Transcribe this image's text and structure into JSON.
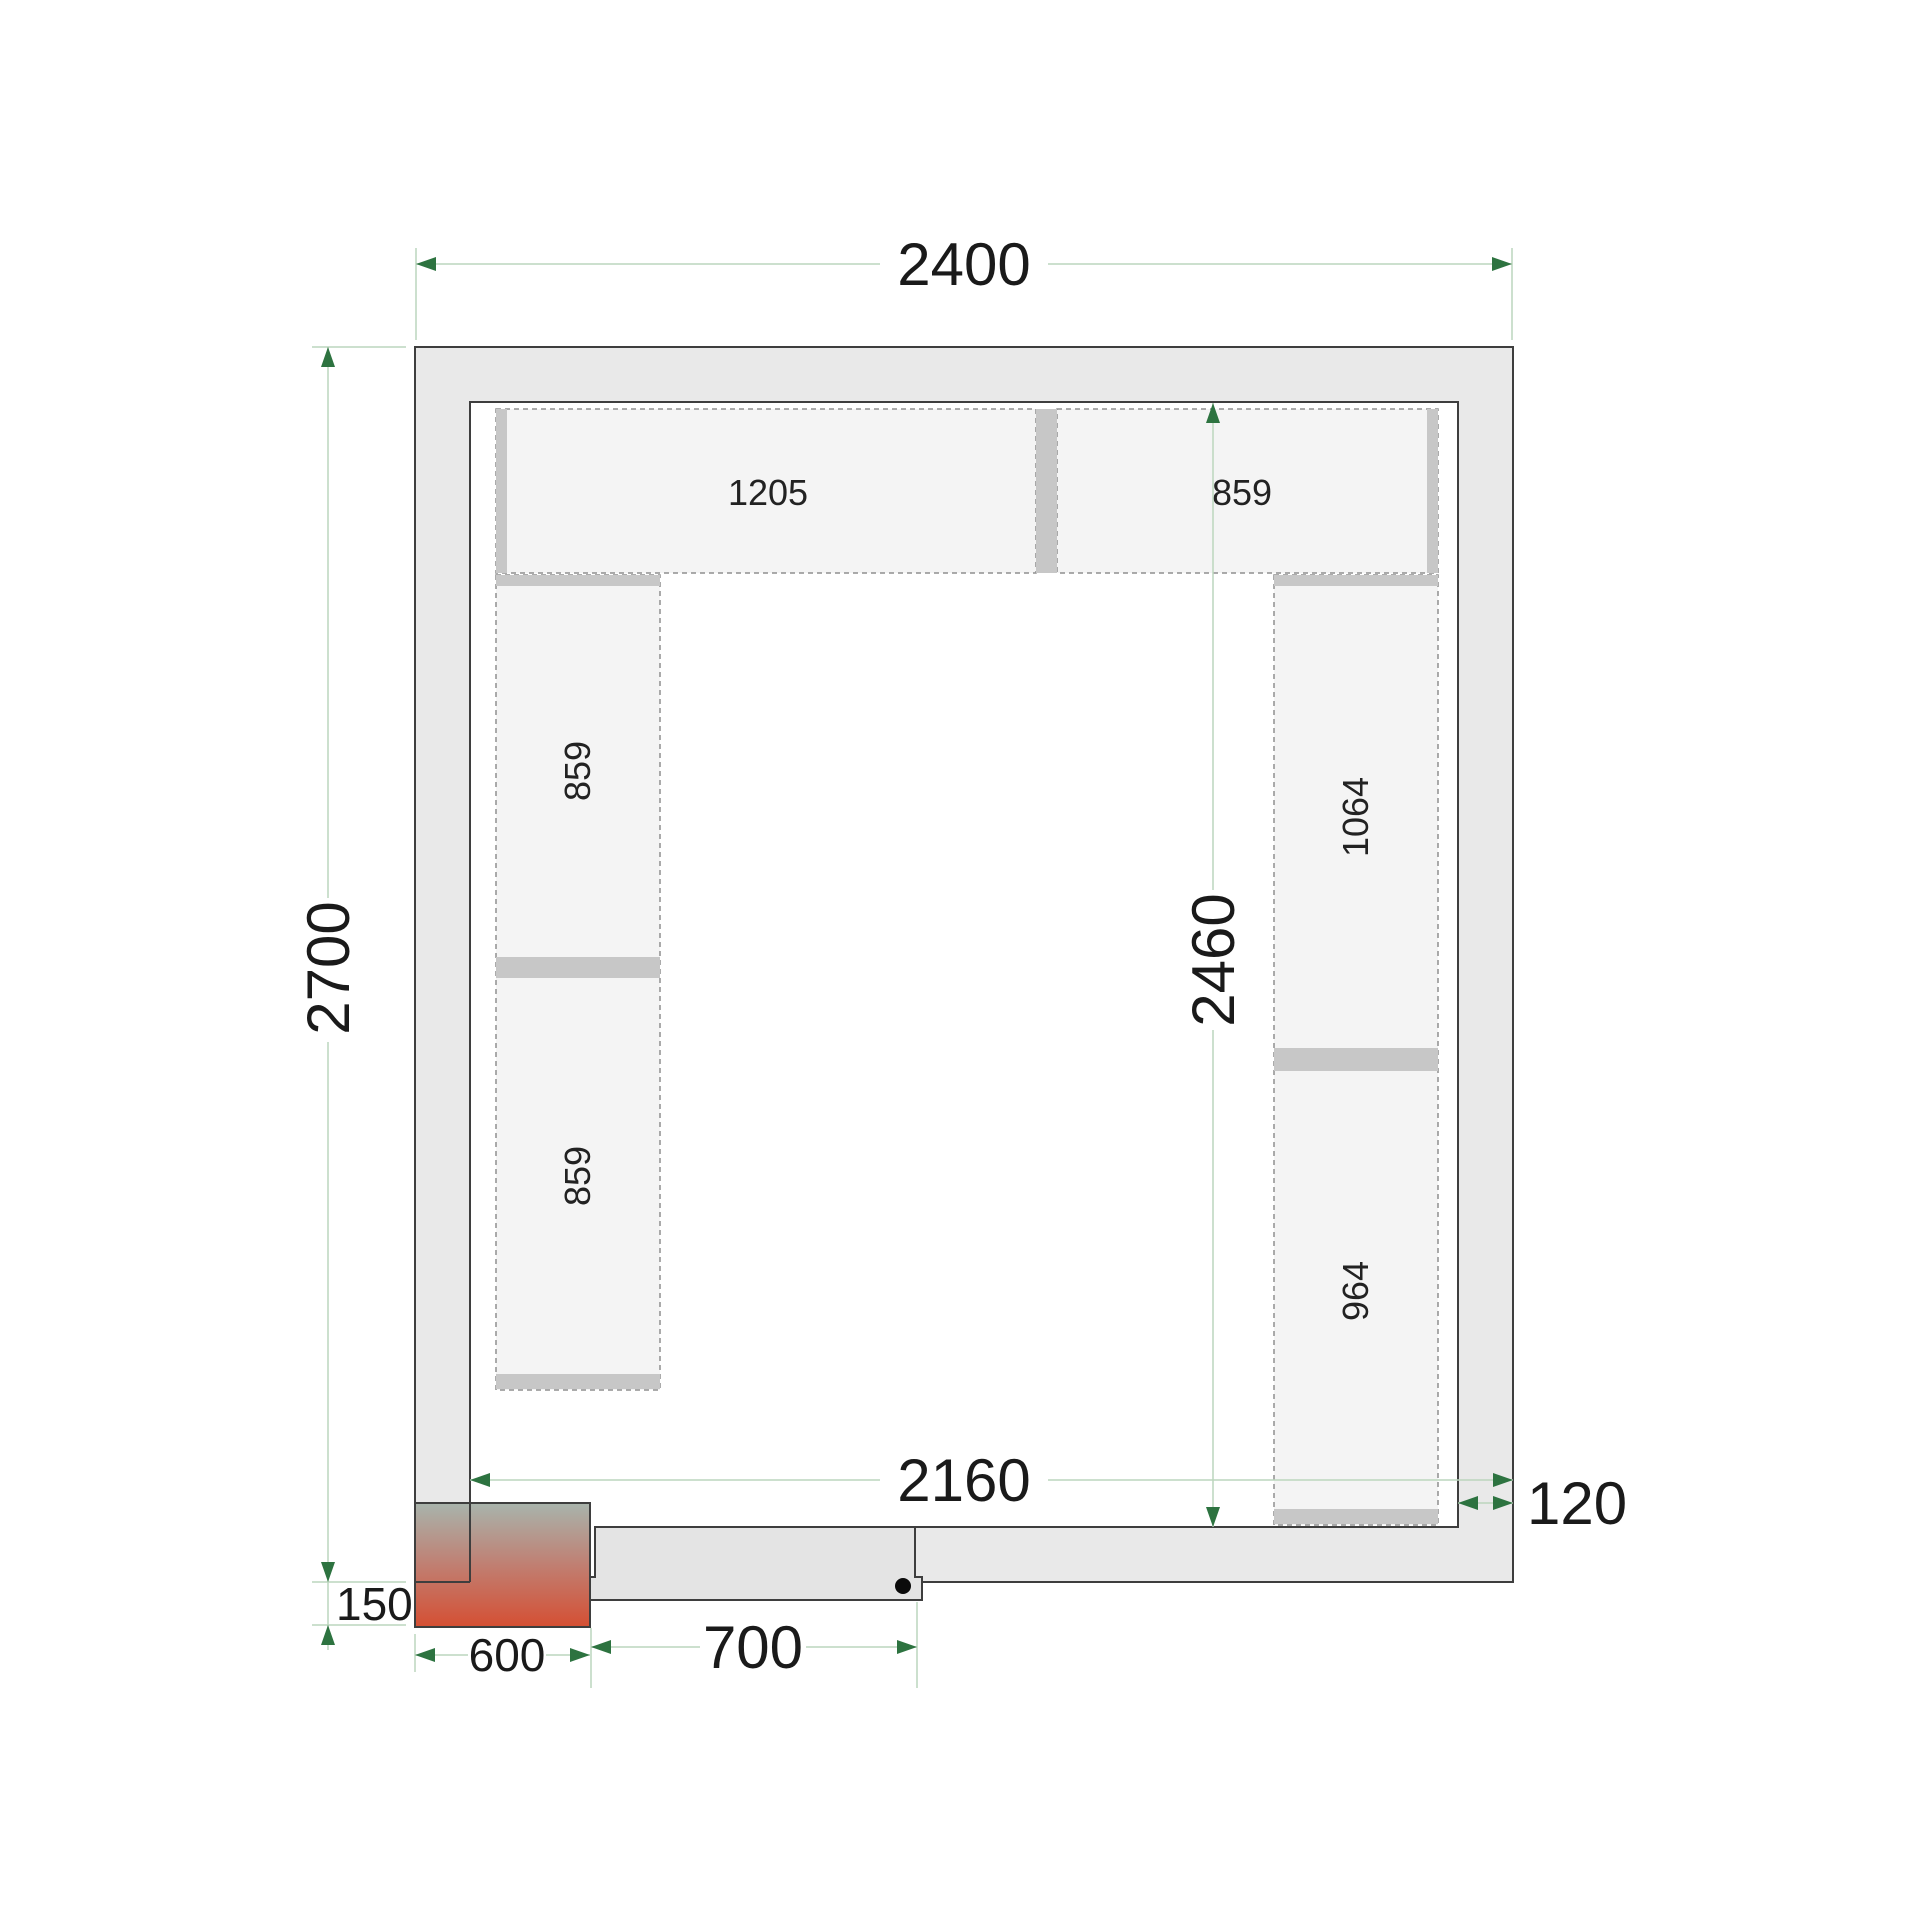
{
  "drawing": {
    "type": "cold-room floor plan, top view",
    "dimensions": {
      "outer_width": "2400",
      "outer_depth": "2700",
      "inner_width": "2160",
      "inner_depth": "2460",
      "wall_thickness": "120",
      "door_opening": "700",
      "corner_unit_width": "600",
      "corner_unit_offset": "150"
    },
    "shelves": {
      "top_row": [
        "1205",
        "859"
      ],
      "left_column": [
        "859",
        "859"
      ],
      "right_column": [
        "1064",
        "964"
      ]
    },
    "colors": {
      "wall_fill": "#e9e9e9",
      "outline": "#3e3e3e",
      "shelf_fill": "#f4f4f4",
      "shelf_dash": "#8f8f8f",
      "shelf_bar": "#c7c7c7",
      "dimension_line": "#bcd6bd",
      "dimension_arrow": "#2d7340",
      "text": "#1a1a1a",
      "unit_gradient_top": "#a8b4ac",
      "unit_gradient_bottom": "#d54f33"
    }
  }
}
